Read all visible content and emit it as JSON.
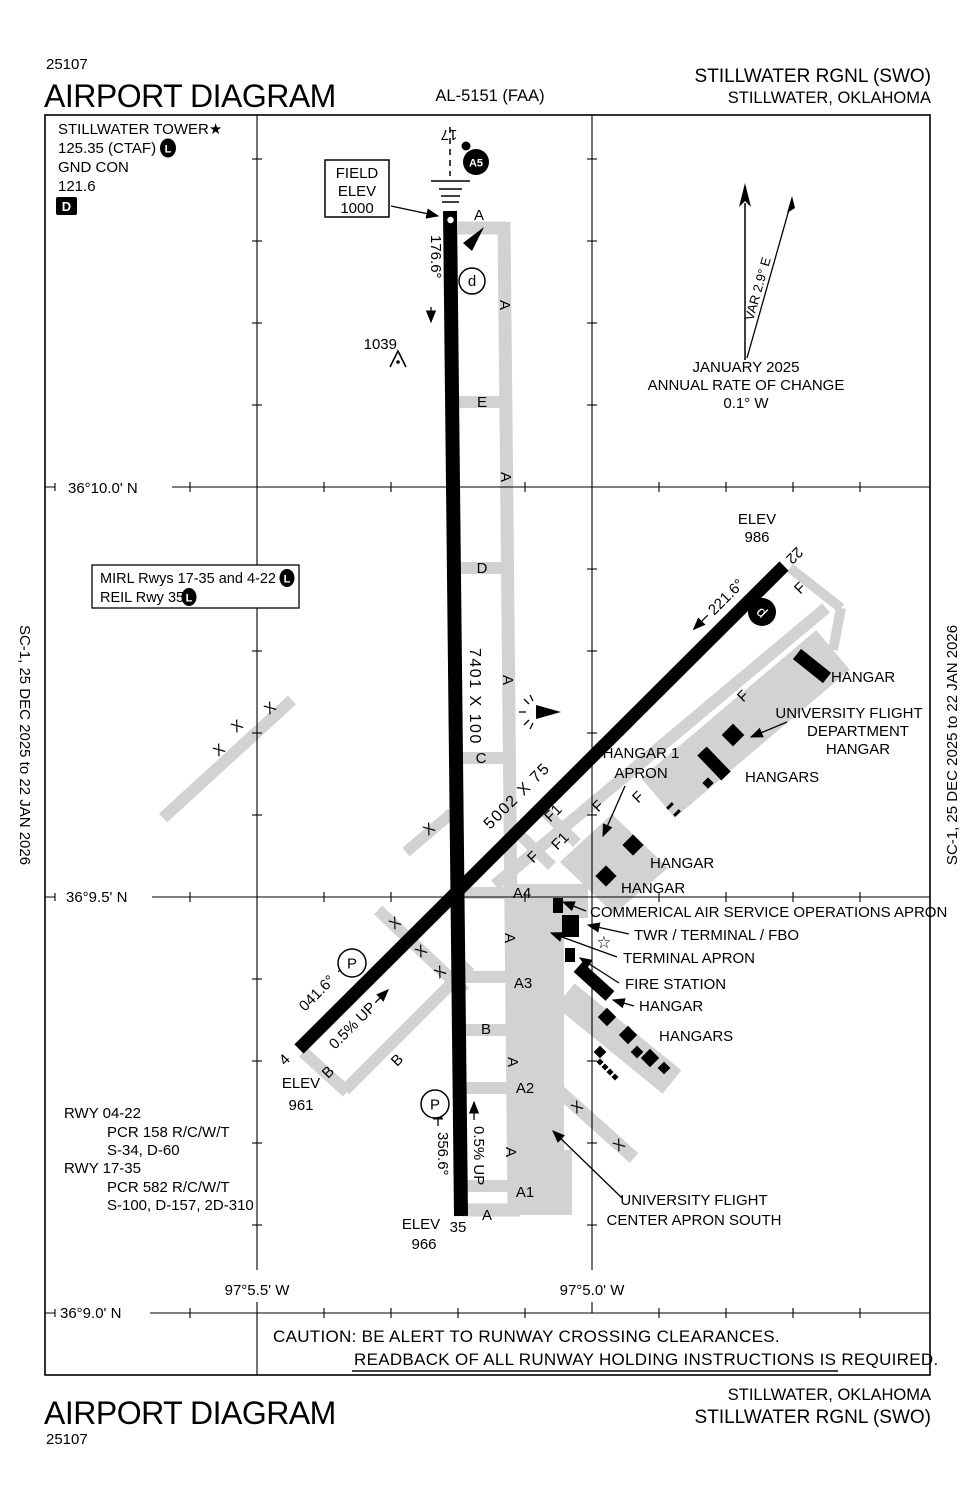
{
  "header": {
    "number": "25107",
    "title": "AIRPORT DIAGRAM",
    "al": "AL-5151 (FAA)",
    "airport": "STILLWATER RGNL (SWO)",
    "city": "STILLWATER, OKLAHOMA"
  },
  "edge_date": "SC-1,  25 DEC 2025  to  22 JAN 2026",
  "comms": {
    "tower": "STILLWATER TOWER★",
    "ctaf": "125.35 (CTAF)",
    "gnd": "GND CON",
    "gnd_freq": "121.6"
  },
  "field_elev": {
    "l1": "FIELD",
    "l2": "ELEV",
    "l3": "1000"
  },
  "compass": {
    "month": "JANUARY 2025",
    "rate_label": "ANNUAL RATE OF CHANGE",
    "rate": "0.1° W",
    "variation": "VAR 2.9° E"
  },
  "lighting": {
    "mirl": "MIRL Rwys 17-35 and 4-22",
    "reil": "REIL Rwy 35"
  },
  "grid": {
    "lat": [
      "36°10.0' N",
      "36°9.5' N",
      "36°9.0' N"
    ],
    "lon": [
      "97°5.5' W",
      "97°5.0' W"
    ]
  },
  "runways": {
    "r1735": {
      "num17": "17",
      "num35": "35",
      "hdg17": "176.6°",
      "hdg35": "356.6°",
      "dims": "7401 X 100",
      "slope": "0.5% UP"
    },
    "r0422": {
      "num04": "4",
      "num22": "22",
      "hdg04": "041.6°",
      "hdg22": "221.6°",
      "dims": "5002 X 75",
      "slope": "0.5% UP"
    }
  },
  "elevations": {
    "label": "ELEV",
    "rwy22": "986",
    "rwy04": "961",
    "rwy35": "966"
  },
  "obstacle": "1039",
  "symbols": {
    "a5": "A5",
    "run_up": "d",
    "parking": "P",
    "l": "L",
    "d_badge": "D",
    "star": "☆",
    "closed_x": "X"
  },
  "taxiways": {
    "a": "A",
    "a1": "A1",
    "a2": "A2",
    "a3": "A3",
    "a4": "A4",
    "b": "B",
    "c": "C",
    "d": "D",
    "e": "E",
    "f": "F",
    "f1": "F1"
  },
  "features": {
    "hangar": "HANGAR",
    "hangars": "HANGARS",
    "hangar1_apron": [
      "HANGAR 1",
      "APRON"
    ],
    "univ_dept": [
      "UNIVERSITY FLIGHT",
      "DEPARTMENT",
      "HANGAR"
    ],
    "commercial_apron": "COMMERICAL AIR SERVICE OPERATIONS APRON",
    "twr": "TWR / TERMINAL / FBO",
    "terminal_apron": "TERMINAL APRON",
    "fire_station": "FIRE STATION",
    "univ_south": [
      "UNIVERSITY FLIGHT",
      "CENTER APRON SOUTH"
    ]
  },
  "runway_data": [
    "RWY 04-22",
    "PCR 158 R/C/W/T",
    "S-34, D-60",
    "RWY 17-35",
    "PCR 582 R/C/W/T",
    "S-100, D-157, 2D-310"
  ],
  "caution": [
    "CAUTION: BE ALERT TO RUNWAY CROSSING CLEARANCES.",
    "READBACK OF ALL RUNWAY HOLDING INSTRUCTIONS IS REQUIRED."
  ],
  "colors": {
    "pavement": "#d2d2d2",
    "ink": "#000000"
  }
}
